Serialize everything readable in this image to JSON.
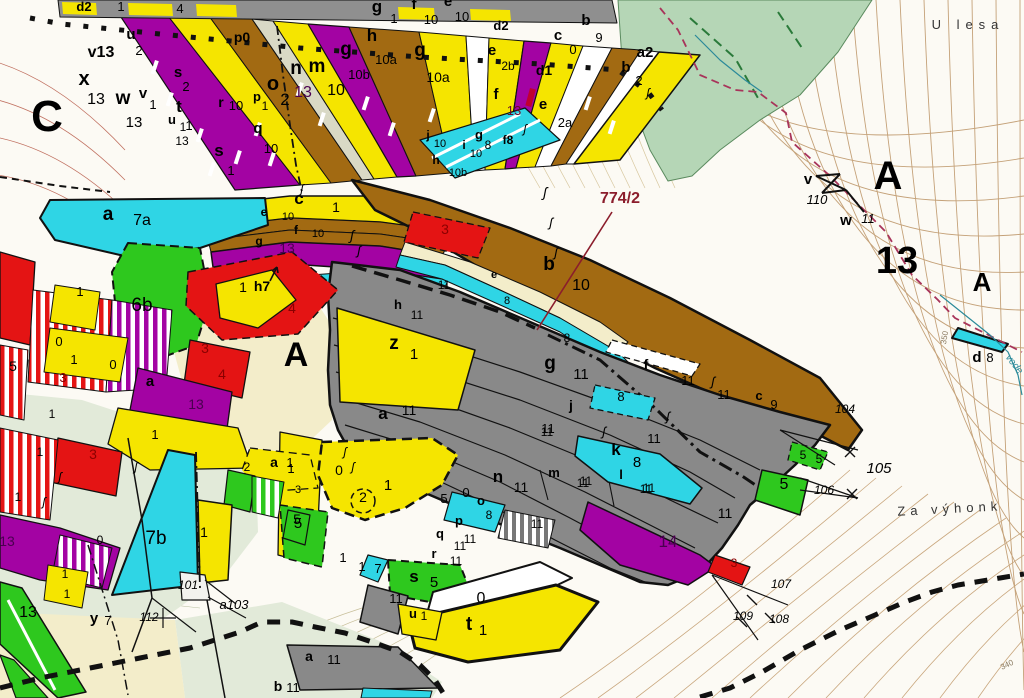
{
  "map": {
    "type": "cadastral-forestry parcel map",
    "highlight_parcel": "774/2",
    "place_names": [
      "U lesa",
      "Za výhonk"
    ],
    "sheet_letters": [
      "C",
      "A",
      "A",
      "A"
    ],
    "big_numbers": [
      "13"
    ],
    "survey_points": [
      "101",
      "103",
      "104",
      "105",
      "106",
      "107",
      "108",
      "109",
      "110",
      "112"
    ],
    "contour_labels": [
      "350",
      "340"
    ],
    "stream_label": "vode",
    "palette": {
      "yellow": "#f5e500",
      "purple": "#a303a3",
      "brown": "#a26a12",
      "cyan": "#2fd5e5",
      "gray": "#898989",
      "red": "#e41414",
      "green": "#2ec81e",
      "forest": "#b5d6b6",
      "cream": "#f3edca",
      "pale_green": "#e2ead9",
      "road": "#d9d9c5",
      "callout_red": "#8b1d2c",
      "boundary_red": "#a8345a",
      "stream_teal": "#2b8a9a"
    }
  },
  "labels": [
    {
      "t": "d2",
      "x": 84,
      "y": 11,
      "s": 13,
      "b": 1
    },
    {
      "t": "1",
      "x": 121,
      "y": 11,
      "s": 13
    },
    {
      "t": "4",
      "x": 180,
      "y": 13,
      "s": 13
    },
    {
      "t": "v13",
      "x": 101,
      "y": 57,
      "s": 16,
      "b": 1
    },
    {
      "t": "x",
      "x": 84,
      "y": 85,
      "s": 20,
      "b": 1
    },
    {
      "t": "13",
      "x": 96,
      "y": 104,
      "s": 16
    },
    {
      "t": "C",
      "x": 47,
      "y": 131,
      "s": 44,
      "b": 1
    },
    {
      "t": "w",
      "x": 123,
      "y": 104,
      "s": 19,
      "b": 1
    },
    {
      "t": "13",
      "x": 134,
      "y": 127,
      "s": 15
    },
    {
      "t": "v",
      "x": 143,
      "y": 98,
      "s": 15,
      "b": 1
    },
    {
      "t": "1",
      "x": 153,
      "y": 109,
      "s": 13
    },
    {
      "t": "u",
      "x": 131,
      "y": 39,
      "s": 15,
      "b": 1
    },
    {
      "t": "2",
      "x": 139,
      "y": 55,
      "s": 13
    },
    {
      "t": "s",
      "x": 178,
      "y": 77,
      "s": 15,
      "b": 1
    },
    {
      "t": "2",
      "x": 186,
      "y": 91,
      "s": 13
    },
    {
      "t": "t",
      "x": 179,
      "y": 112,
      "s": 17,
      "b": 1
    },
    {
      "t": "1",
      "x": 189,
      "y": 130,
      "s": 13
    },
    {
      "t": "u",
      "x": 172,
      "y": 124,
      "s": 13,
      "b": 1
    },
    {
      "t": "1",
      "x": 183,
      "y": 131,
      "s": 12
    },
    {
      "t": "13",
      "x": 182,
      "y": 145,
      "s": 12
    },
    {
      "t": "s",
      "x": 219,
      "y": 156,
      "s": 17,
      "b": 1
    },
    {
      "t": "1",
      "x": 231,
      "y": 175,
      "s": 13
    },
    {
      "t": "r",
      "x": 221,
      "y": 107,
      "s": 14,
      "b": 1
    },
    {
      "t": "10",
      "x": 236,
      "y": 110,
      "s": 13
    },
    {
      "t": "q",
      "x": 258,
      "y": 133,
      "s": 15,
      "b": 1
    },
    {
      "t": "10",
      "x": 271,
      "y": 153,
      "s": 13
    },
    {
      "t": "o",
      "x": 273,
      "y": 90,
      "s": 20,
      "b": 1
    },
    {
      "t": "2",
      "x": 285,
      "y": 105,
      "s": 17
    },
    {
      "t": "p0",
      "x": 242,
      "y": 42,
      "s": 14,
      "b": 1
    },
    {
      "t": "p",
      "x": 257,
      "y": 101,
      "s": 13,
      "b": 1
    },
    {
      "t": "1",
      "x": 265,
      "y": 110,
      "s": 12
    },
    {
      "t": "n",
      "x": 296,
      "y": 74,
      "s": 19,
      "b": 1
    },
    {
      "t": "m",
      "x": 317,
      "y": 72,
      "s": 19,
      "b": 1
    },
    {
      "t": "13",
      "x": 303,
      "y": 97,
      "s": 16,
      "c": "#4a0050"
    },
    {
      "t": "10",
      "x": 336,
      "y": 95,
      "s": 16
    },
    {
      "t": "g",
      "x": 346,
      "y": 55,
      "s": 19,
      "b": 1
    },
    {
      "t": "10b",
      "x": 359,
      "y": 79,
      "s": 13
    },
    {
      "t": "h",
      "x": 372,
      "y": 41,
      "s": 17,
      "b": 1
    },
    {
      "t": "10a",
      "x": 386,
      "y": 64,
      "s": 13
    },
    {
      "t": "g",
      "x": 420,
      "y": 56,
      "s": 19,
      "b": 1
    },
    {
      "t": "10a",
      "x": 438,
      "y": 82,
      "s": 14
    },
    {
      "t": "g",
      "x": 377,
      "y": 12,
      "s": 17,
      "b": 1
    },
    {
      "t": "1",
      "x": 394,
      "y": 23,
      "s": 13
    },
    {
      "t": "f",
      "x": 414,
      "y": 9,
      "s": 15,
      "b": 1
    },
    {
      "t": "10",
      "x": 431,
      "y": 24,
      "s": 13
    },
    {
      "t": "e",
      "x": 448,
      "y": 6,
      "s": 15,
      "b": 1
    },
    {
      "t": "10",
      "x": 462,
      "y": 21,
      "s": 13
    },
    {
      "t": "d2",
      "x": 501,
      "y": 30,
      "s": 13,
      "b": 1
    },
    {
      "t": "e",
      "x": 492,
      "y": 55,
      "s": 15,
      "b": 1
    },
    {
      "t": "2b",
      "x": 508,
      "y": 70,
      "s": 12
    },
    {
      "t": "c",
      "x": 558,
      "y": 40,
      "s": 15,
      "b": 1
    },
    {
      "t": "0",
      "x": 573,
      "y": 54,
      "s": 13
    },
    {
      "t": "b",
      "x": 586,
      "y": 25,
      "s": 15,
      "b": 1
    },
    {
      "t": "9",
      "x": 599,
      "y": 42,
      "s": 13
    },
    {
      "t": "a2",
      "x": 645,
      "y": 57,
      "s": 15,
      "b": 1
    },
    {
      "t": "b",
      "x": 626,
      "y": 72,
      "s": 15,
      "b": 1
    },
    {
      "t": "2",
      "x": 639,
      "y": 85,
      "s": 13
    },
    {
      "t": "d1",
      "x": 544,
      "y": 75,
      "s": 14,
      "b": 1
    },
    {
      "t": "f",
      "x": 496,
      "y": 99,
      "s": 15,
      "b": 1
    },
    {
      "t": "13",
      "x": 514,
      "y": 115,
      "s": 13,
      "c": "#6a0a28"
    },
    {
      "t": "e",
      "x": 543,
      "y": 109,
      "s": 15,
      "b": 1
    },
    {
      "t": "2a",
      "x": 565,
      "y": 127,
      "s": 13
    },
    {
      "t": "g",
      "x": 479,
      "y": 139,
      "s": 13,
      "b": 1
    },
    {
      "t": "8",
      "x": 488,
      "y": 149,
      "s": 12
    },
    {
      "t": "f8",
      "x": 508,
      "y": 144,
      "s": 12,
      "b": 1
    },
    {
      "t": "j",
      "x": 428,
      "y": 139,
      "s": 12,
      "b": 1
    },
    {
      "t": "10",
      "x": 440,
      "y": 147,
      "s": 11
    },
    {
      "t": "i",
      "x": 464,
      "y": 149,
      "s": 12,
      "b": 1
    },
    {
      "t": "10",
      "x": 476,
      "y": 157,
      "s": 11
    },
    {
      "t": "h",
      "x": 436,
      "y": 164,
      "s": 12,
      "b": 1
    },
    {
      "t": "10b",
      "x": 458,
      "y": 176,
      "s": 11
    },
    {
      "t": "c",
      "x": 299,
      "y": 204,
      "s": 17,
      "b": 1
    },
    {
      "t": "1",
      "x": 336,
      "y": 212,
      "s": 14
    },
    {
      "t": "e",
      "x": 264,
      "y": 216,
      "s": 12,
      "b": 1
    },
    {
      "t": "10",
      "x": 288,
      "y": 220,
      "s": 11
    },
    {
      "t": "f",
      "x": 296,
      "y": 234,
      "s": 12,
      "b": 1
    },
    {
      "t": "10",
      "x": 318,
      "y": 237,
      "s": 11
    },
    {
      "t": "g",
      "x": 259,
      "y": 245,
      "s": 12,
      "b": 1
    },
    {
      "t": "13",
      "x": 287,
      "y": 253,
      "s": 14,
      "c": "#4a0050"
    },
    {
      "t": "h7",
      "x": 262,
      "y": 291,
      "s": 14,
      "b": 1
    },
    {
      "t": "a",
      "x": 108,
      "y": 220,
      "s": 19,
      "b": 1
    },
    {
      "t": "7a",
      "x": 142,
      "y": 225,
      "s": 16
    },
    {
      "t": "1",
      "x": 80,
      "y": 296,
      "s": 13
    },
    {
      "t": "6b",
      "x": 142,
      "y": 311,
      "s": 19
    },
    {
      "t": "0",
      "x": 59,
      "y": 346,
      "s": 13
    },
    {
      "t": "1",
      "x": 74,
      "y": 364,
      "s": 13
    },
    {
      "t": "5",
      "x": 13,
      "y": 371,
      "s": 14
    },
    {
      "t": "3",
      "x": 63,
      "y": 382,
      "s": 13,
      "c": "#8b0000"
    },
    {
      "t": "0",
      "x": 113,
      "y": 369,
      "s": 13
    },
    {
      "t": "a",
      "x": 150,
      "y": 386,
      "s": 15,
      "b": 1
    },
    {
      "t": "3",
      "x": 205,
      "y": 353,
      "s": 14,
      "c": "#8b0000"
    },
    {
      "t": "4",
      "x": 292,
      "y": 313,
      "s": 14,
      "c": "#8b0000"
    },
    {
      "t": "1",
      "x": 243,
      "y": 292,
      "s": 14
    },
    {
      "t": "4",
      "x": 222,
      "y": 379,
      "s": 14,
      "c": "#8b0000"
    },
    {
      "t": "13",
      "x": 196,
      "y": 409,
      "s": 14,
      "c": "#4a0050"
    },
    {
      "t": "1",
      "x": 155,
      "y": 439,
      "s": 13
    },
    {
      "t": "1",
      "x": 52,
      "y": 418,
      "s": 12
    },
    {
      "t": "A",
      "x": 296,
      "y": 366,
      "s": 34,
      "b": 1
    },
    {
      "t": "a",
      "x": 274,
      "y": 467,
      "s": 14,
      "b": 1
    },
    {
      "t": "1",
      "x": 290,
      "y": 467,
      "s": 13
    },
    {
      "t": "2",
      "x": 247,
      "y": 471,
      "s": 12
    },
    {
      "t": "3",
      "x": 93,
      "y": 459,
      "s": 14,
      "c": "#8b0000"
    },
    {
      "t": "1",
      "x": 40,
      "y": 456,
      "s": 12
    },
    {
      "t": "1",
      "x": 18,
      "y": 501,
      "s": 12
    },
    {
      "t": "13",
      "x": 7,
      "y": 546,
      "s": 14,
      "c": "#4a0050"
    },
    {
      "t": "0",
      "x": 100,
      "y": 544,
      "s": 12
    },
    {
      "t": "7b",
      "x": 156,
      "y": 544,
      "s": 19
    },
    {
      "t": "1",
      "x": 204,
      "y": 537,
      "s": 14
    },
    {
      "t": "1",
      "x": 65,
      "y": 578,
      "s": 12
    },
    {
      "t": "1",
      "x": 67,
      "y": 598,
      "s": 12
    },
    {
      "t": "5",
      "x": 297,
      "y": 524,
      "s": 14
    },
    {
      "t": "13",
      "x": 28,
      "y": 617,
      "s": 16
    },
    {
      "t": "y",
      "x": 94,
      "y": 623,
      "s": 15,
      "b": 1
    },
    {
      "t": "7",
      "x": 108,
      "y": 625,
      "s": 13
    },
    {
      "t": "112",
      "x": 149,
      "y": 621,
      "s": 12,
      "i": 1
    },
    {
      "t": "101",
      "x": 188,
      "y": 589,
      "s": 12,
      "i": 1
    },
    {
      "t": "a103",
      "x": 234,
      "y": 609,
      "s": 13,
      "i": 1
    },
    {
      "t": "b",
      "x": 278,
      "y": 691,
      "s": 14,
      "b": 1
    },
    {
      "t": "11",
      "x": 293,
      "y": 692,
      "s": 13
    },
    {
      "t": "a",
      "x": 309,
      "y": 661,
      "s": 14,
      "b": 1
    },
    {
      "t": "11",
      "x": 334,
      "y": 664,
      "s": 13
    },
    {
      "t": "774/2",
      "x": 620,
      "y": 203,
      "s": 16,
      "b": 1,
      "c": "#8b1d2c"
    },
    {
      "t": "3",
      "x": 445,
      "y": 234,
      "s": 14,
      "c": "#8b0000"
    },
    {
      "t": "b",
      "x": 549,
      "y": 270,
      "s": 19,
      "b": 1
    },
    {
      "t": "10",
      "x": 581,
      "y": 290,
      "s": 16
    },
    {
      "t": "e",
      "x": 494,
      "y": 278,
      "s": 11,
      "b": 1
    },
    {
      "t": "8",
      "x": 507,
      "y": 304,
      "s": 11
    },
    {
      "t": "11",
      "x": 444,
      "y": 289,
      "s": 12
    },
    {
      "t": "11",
      "x": 417,
      "y": 319,
      "s": 12
    },
    {
      "t": "h",
      "x": 398,
      "y": 309,
      "s": 13,
      "b": 1
    },
    {
      "t": "z",
      "x": 394,
      "y": 349,
      "s": 19,
      "b": 1
    },
    {
      "t": "1",
      "x": 414,
      "y": 359,
      "s": 15
    },
    {
      "t": "8",
      "x": 567,
      "y": 342,
      "s": 12
    },
    {
      "t": "g",
      "x": 550,
      "y": 369,
      "s": 19,
      "b": 1
    },
    {
      "t": "11",
      "x": 581,
      "y": 379,
      "s": 15
    },
    {
      "t": "a",
      "x": 383,
      "y": 419,
      "s": 17,
      "b": 1
    },
    {
      "t": "11",
      "x": 409,
      "y": 415,
      "s": 14
    },
    {
      "t": "j",
      "x": 571,
      "y": 410,
      "s": 14,
      "b": 1
    },
    {
      "t": "11",
      "x": 548,
      "y": 433,
      "s": 13
    },
    {
      "t": "f",
      "x": 646,
      "y": 369,
      "s": 14,
      "b": 1
    },
    {
      "t": "11",
      "x": 688,
      "y": 385,
      "s": 13
    },
    {
      "t": "11",
      "x": 724,
      "y": 399,
      "s": 13
    },
    {
      "t": "c",
      "x": 759,
      "y": 400,
      "s": 13,
      "b": 1
    },
    {
      "t": "9",
      "x": 774,
      "y": 409,
      "s": 13
    },
    {
      "t": "8",
      "x": 621,
      "y": 401,
      "s": 13
    },
    {
      "t": "k",
      "x": 616,
      "y": 455,
      "s": 17,
      "b": 1
    },
    {
      "t": "8",
      "x": 637,
      "y": 467,
      "s": 15
    },
    {
      "t": "11",
      "x": 654,
      "y": 443,
      "s": 13
    },
    {
      "t": "11",
      "x": 586,
      "y": 485,
      "s": 12
    },
    {
      "t": "11",
      "x": 649,
      "y": 492,
      "s": 12
    },
    {
      "t": "11",
      "x": 725,
      "y": 518,
      "s": 14
    },
    {
      "t": "11",
      "x": 547,
      "y": 436,
      "s": 12
    },
    {
      "t": "14",
      "x": 668,
      "y": 547,
      "s": 17,
      "c": "#4a0050"
    },
    {
      "t": "3",
      "x": 734,
      "y": 567,
      "s": 12,
      "c": "#8b0000"
    },
    {
      "t": "104",
      "x": 845,
      "y": 413,
      "s": 12,
      "i": 1
    },
    {
      "t": "105",
      "x": 879,
      "y": 473,
      "s": 15,
      "i": 1
    },
    {
      "t": "106",
      "x": 824,
      "y": 494,
      "s": 12,
      "i": 1
    },
    {
      "t": "107",
      "x": 781,
      "y": 588,
      "s": 12,
      "i": 1
    },
    {
      "t": "108",
      "x": 779,
      "y": 623,
      "s": 12,
      "i": 1
    },
    {
      "t": "109",
      "x": 743,
      "y": 620,
      "s": 12,
      "i": 1
    },
    {
      "t": "5",
      "x": 803,
      "y": 459,
      "s": 12
    },
    {
      "t": "5",
      "x": 819,
      "y": 463,
      "s": 12
    },
    {
      "t": "5",
      "x": 784,
      "y": 489,
      "s": 16
    },
    {
      "t": "n",
      "x": 498,
      "y": 482,
      "s": 17,
      "b": 1
    },
    {
      "t": "11",
      "x": 521,
      "y": 492,
      "s": 14
    },
    {
      "t": "m",
      "x": 554,
      "y": 477,
      "s": 13,
      "b": 1
    },
    {
      "t": "11",
      "x": 583,
      "y": 487,
      "s": 12
    },
    {
      "t": "l",
      "x": 621,
      "y": 479,
      "s": 13,
      "b": 1
    },
    {
      "t": "11",
      "x": 646,
      "y": 493,
      "s": 12
    },
    {
      "t": "5",
      "x": 444,
      "y": 503,
      "s": 13
    },
    {
      "t": "0",
      "x": 466,
      "y": 497,
      "s": 13
    },
    {
      "t": "o",
      "x": 481,
      "y": 505,
      "s": 13,
      "b": 1
    },
    {
      "t": "8",
      "x": 489,
      "y": 519,
      "s": 12
    },
    {
      "t": "p",
      "x": 459,
      "y": 525,
      "s": 13,
      "b": 1
    },
    {
      "t": "11",
      "x": 470,
      "y": 543,
      "s": 12
    },
    {
      "t": "q",
      "x": 440,
      "y": 538,
      "s": 13,
      "b": 1
    },
    {
      "t": "11",
      "x": 460,
      "y": 550,
      "s": 12
    },
    {
      "t": "r",
      "x": 434,
      "y": 558,
      "s": 13,
      "b": 1
    },
    {
      "t": "11",
      "x": 456,
      "y": 565,
      "s": 12
    },
    {
      "t": "11",
      "x": 537,
      "y": 528,
      "s": 12
    },
    {
      "t": "0",
      "x": 339,
      "y": 475,
      "s": 14
    },
    {
      "t": "1",
      "x": 388,
      "y": 490,
      "s": 15
    },
    {
      "t": "2",
      "x": 363,
      "y": 502,
      "s": 14
    },
    {
      "t": "1",
      "x": 291,
      "y": 473,
      "s": 13
    },
    {
      "t": "3",
      "x": 298,
      "y": 493,
      "s": 11
    },
    {
      "t": "5",
      "x": 298,
      "y": 528,
      "s": 15
    },
    {
      "t": "1",
      "x": 343,
      "y": 562,
      "s": 13
    },
    {
      "t": "1",
      "x": 362,
      "y": 571,
      "s": 13
    },
    {
      "t": "7",
      "x": 378,
      "y": 573,
      "s": 13
    },
    {
      "t": "s",
      "x": 414,
      "y": 582,
      "s": 17,
      "b": 1
    },
    {
      "t": "5",
      "x": 434,
      "y": 587,
      "s": 15
    },
    {
      "t": "11",
      "x": 396,
      "y": 603,
      "s": 13
    },
    {
      "t": "u",
      "x": 413,
      "y": 618,
      "s": 13,
      "b": 1
    },
    {
      "t": "1",
      "x": 424,
      "y": 620,
      "s": 12
    },
    {
      "t": "0",
      "x": 481,
      "y": 603,
      "s": 16
    },
    {
      "t": "t",
      "x": 469,
      "y": 630,
      "s": 19,
      "b": 1
    },
    {
      "t": "1",
      "x": 483,
      "y": 635,
      "s": 15
    },
    {
      "t": "v",
      "x": 808,
      "y": 184,
      "s": 15,
      "b": 1
    },
    {
      "t": "110",
      "x": 817,
      "y": 204,
      "s": 13,
      "i": 1
    },
    {
      "t": "w",
      "x": 846,
      "y": 225,
      "s": 15,
      "b": 1
    },
    {
      "t": "11",
      "x": 868,
      "y": 223,
      "s": 13,
      "i": 1
    },
    {
      "t": "A",
      "x": 888,
      "y": 189,
      "s": 40,
      "b": 1
    },
    {
      "t": "13",
      "x": 897,
      "y": 273,
      "s": 38,
      "b": 1
    },
    {
      "t": "A",
      "x": 982,
      "y": 291,
      "s": 26,
      "b": 1
    },
    {
      "t": "d",
      "x": 977,
      "y": 362,
      "s": 15,
      "b": 1
    },
    {
      "t": "8",
      "x": 990,
      "y": 362,
      "s": 13
    },
    {
      "t": "U lesa",
      "x": 968,
      "y": 29,
      "s": 13,
      "c": "#333333",
      "sp": 6
    },
    {
      "t": "Za výhonk",
      "x": 950,
      "y": 513,
      "s": 13,
      "c": "#333333",
      "r": -3,
      "sp": 5
    },
    {
      "t": "vode",
      "x": 1012,
      "y": 366,
      "s": 10,
      "i": 1,
      "c": "#2b8a9a",
      "r": 52
    },
    {
      "t": "350",
      "x": 947,
      "y": 338,
      "s": 8,
      "c": "#8a7a60",
      "r": -80
    },
    {
      "t": "340",
      "x": 1008,
      "y": 667,
      "s": 8,
      "c": "#8a7a60",
      "r": -25
    },
    {
      "t": "ʃ",
      "x": 352,
      "y": 240,
      "s": 14,
      "i": 1
    },
    {
      "t": "ʃ",
      "x": 359,
      "y": 255,
      "s": 13,
      "i": 1
    },
    {
      "t": "ʃ",
      "x": 545,
      "y": 197,
      "s": 14,
      "i": 1
    },
    {
      "t": "ʃ",
      "x": 551,
      "y": 227,
      "s": 13,
      "i": 1
    },
    {
      "t": "ʃ",
      "x": 556,
      "y": 257,
      "s": 13,
      "i": 1
    },
    {
      "t": "ʃ",
      "x": 302,
      "y": 193,
      "s": 12,
      "i": 1
    },
    {
      "t": "ʃ",
      "x": 525,
      "y": 133,
      "s": 12,
      "i": 1
    },
    {
      "t": "ʃ",
      "x": 648,
      "y": 97,
      "s": 12,
      "i": 1
    },
    {
      "t": "ʃ",
      "x": 713,
      "y": 386,
      "s": 13,
      "i": 1
    },
    {
      "t": "ʃ",
      "x": 668,
      "y": 421,
      "s": 13,
      "i": 1
    },
    {
      "t": "ʃ",
      "x": 604,
      "y": 436,
      "s": 13,
      "i": 1
    },
    {
      "t": "ʃ",
      "x": 345,
      "y": 456,
      "s": 12,
      "i": 1
    },
    {
      "t": "ʃ",
      "x": 353,
      "y": 471,
      "s": 12,
      "i": 1
    },
    {
      "t": "ʃ",
      "x": 136,
      "y": 471,
      "s": 12,
      "i": 1
    },
    {
      "t": "ʃ",
      "x": 60,
      "y": 481,
      "s": 12,
      "i": 1
    },
    {
      "t": "ʃ",
      "x": 44,
      "y": 506,
      "s": 12,
      "i": 1
    }
  ]
}
